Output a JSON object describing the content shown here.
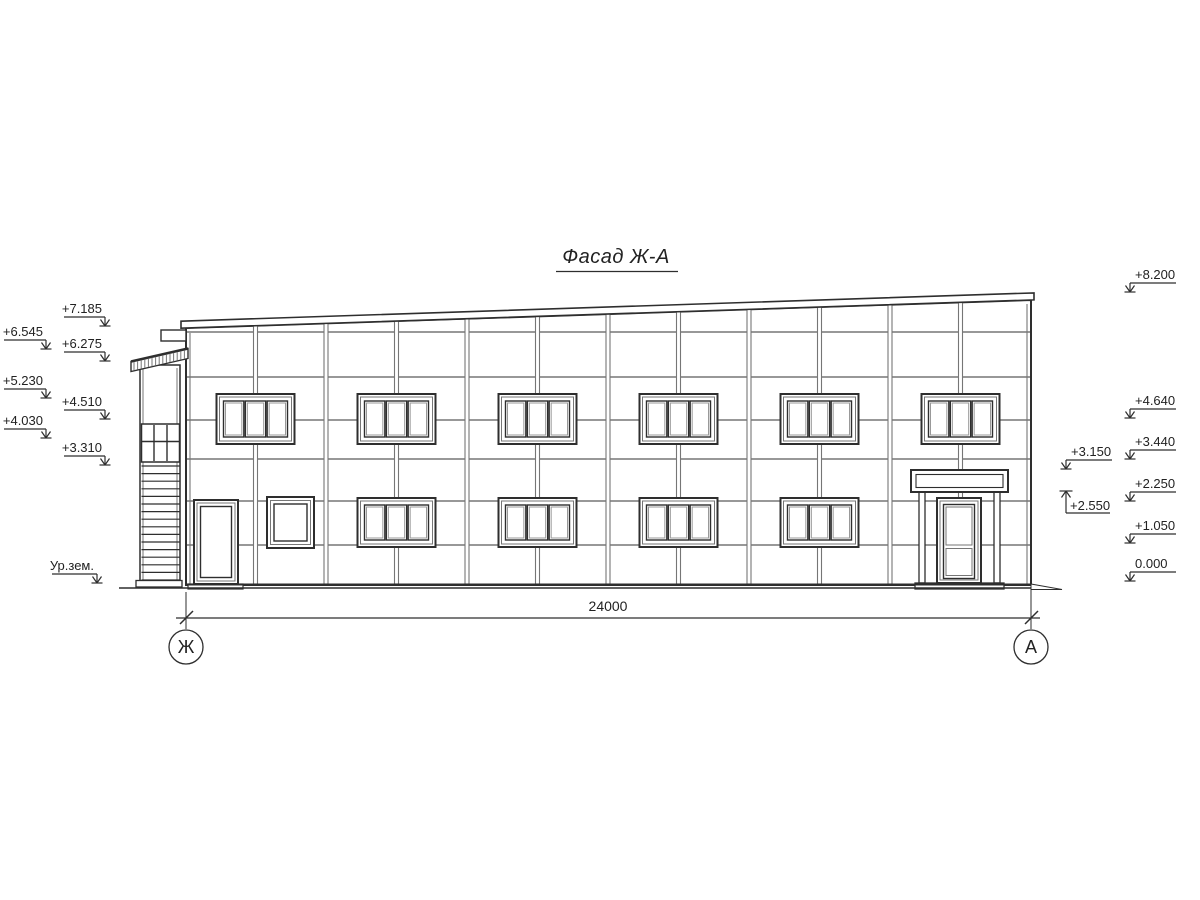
{
  "title": "Фасад Ж-А",
  "dimension_label": "24000",
  "axis_left": "Ж",
  "axis_right": "А",
  "ground_level_label": "Ур.зем.",
  "elevations_left": [
    {
      "label": "+7.185",
      "y": 317,
      "col": "inner"
    },
    {
      "label": "+6.545",
      "y": 340,
      "col": "outer"
    },
    {
      "label": "+6.275",
      "y": 352,
      "col": "inner"
    },
    {
      "label": "+5.230",
      "y": 389,
      "col": "outer"
    },
    {
      "label": "+4.510",
      "y": 410,
      "col": "inner"
    },
    {
      "label": "+4.030",
      "y": 429,
      "col": "outer"
    },
    {
      "label": "+3.310",
      "y": 456,
      "col": "inner"
    }
  ],
  "elevations_right": [
    {
      "label": "+8.200",
      "y": 283,
      "col": "outer",
      "dir": "down"
    },
    {
      "label": "+4.640",
      "y": 409,
      "col": "outer",
      "dir": "down"
    },
    {
      "label": "+3.440",
      "y": 450,
      "col": "outer",
      "dir": "down"
    },
    {
      "label": "+3.150",
      "y": 460,
      "col": "inner",
      "dir": "down"
    },
    {
      "label": "+2.550",
      "y": 513,
      "col": "inner",
      "dir": "up"
    },
    {
      "label": "+2.250",
      "y": 492,
      "col": "outer",
      "dir": "down"
    },
    {
      "label": "+1.050",
      "y": 534,
      "col": "outer",
      "dir": "down"
    },
    {
      "label": "0.000",
      "y": 572,
      "col": "outer",
      "dir": "down"
    }
  ],
  "colors": {
    "line": "#2e2e2e",
    "line_gray": "#767676",
    "bg": "#ffffff"
  }
}
